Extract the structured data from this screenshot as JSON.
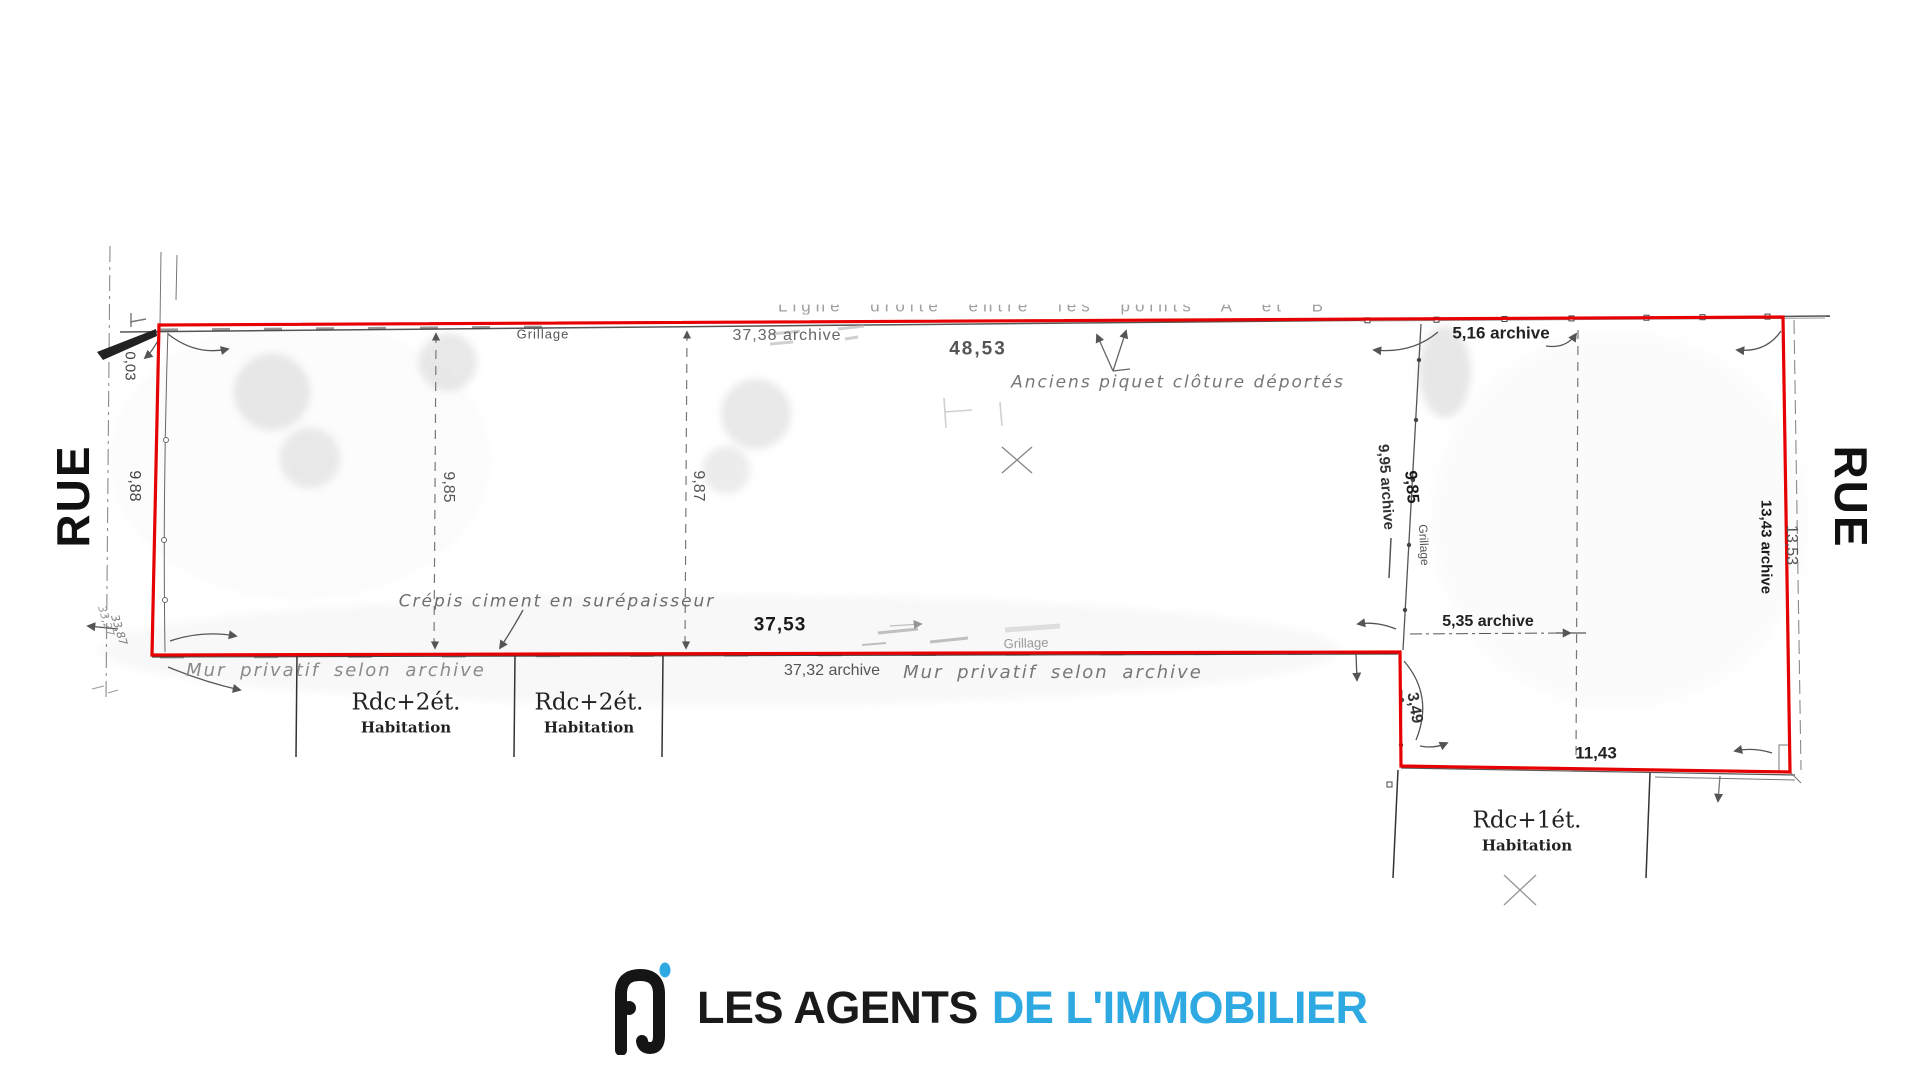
{
  "plan": {
    "streets": {
      "left": "RUE",
      "right": "RUE"
    },
    "top": {
      "faded_note": "Ligne droite entre   les points A et B",
      "grillage": "Grillage",
      "dim_archive": "37,38 archive",
      "dim_main": "48,53",
      "annotation": "Anciens piquet clôture déportés",
      "dim_right_archive": "5,16 archive"
    },
    "left_side": {
      "dim_offset": "0,03",
      "dim_main": "9,88",
      "archive_a": "33,27",
      "archive_b": "33,87"
    },
    "middle": {
      "dim_a": "9,85",
      "dim_b": "9,87"
    },
    "fence": {
      "dim_archive": "9,95 archive",
      "dim_main": "9,85",
      "label": "Grillage"
    },
    "right_side": {
      "dim_main": "13,53",
      "dim_archive": "13,43 archive"
    },
    "bottom": {
      "crepis": "Crépis ciment en surépaisseur",
      "mur_left": "Mur privatif selon archive",
      "dim_main": "37,53",
      "grillage": "Grillage",
      "dim_archive": "37,32 archive",
      "mur_right": "Mur privatif selon archive"
    },
    "notch": {
      "dim_archive": "5,35 archive",
      "dim_side": "3,49",
      "dim_bottom": "11,43"
    },
    "buildings": [
      {
        "line1": "Rdc+2ét.",
        "line2": "Habitation"
      },
      {
        "line1": "Rdc+2ét.",
        "line2": "Habitation"
      },
      {
        "line1": "Rdc+1ét.",
        "line2": "Habitation"
      }
    ],
    "colors": {
      "boundary": "#e60000",
      "ink": "#555555",
      "faded": "#999999"
    }
  },
  "logo": {
    "name_black": "LES AGENTS",
    "name_blue": "DE L'IMMOBILIER",
    "colors": {
      "black": "#1a1a1a",
      "blue": "#2fa9e1"
    }
  }
}
